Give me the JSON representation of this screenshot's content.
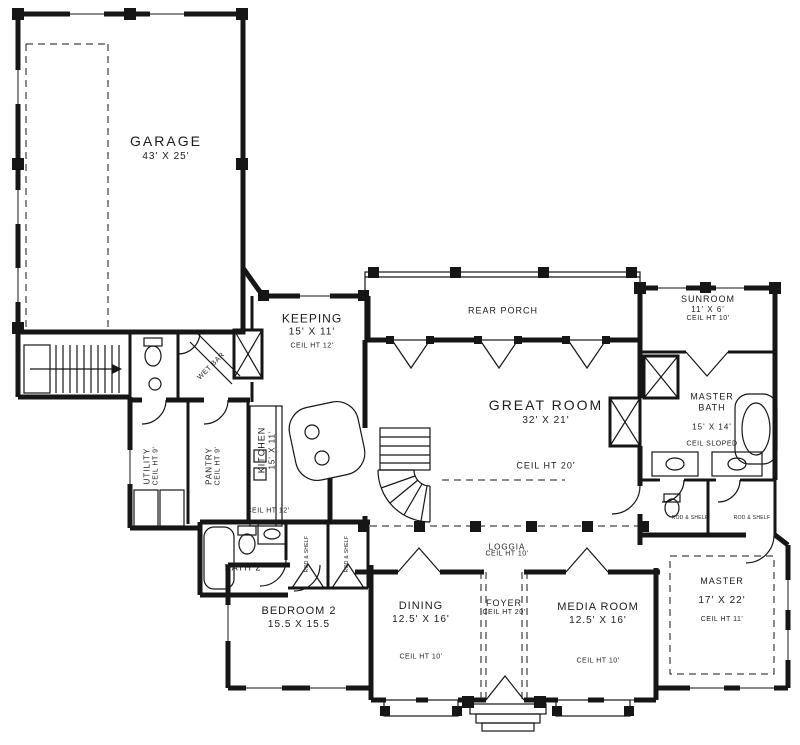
{
  "plan_title": "First floor plan",
  "colors": {
    "ink": "#161616",
    "paper": "#ffffff"
  },
  "rooms": {
    "garage": {
      "name": "GARAGE",
      "dims": "43' X 25'"
    },
    "keeping": {
      "name": "KEEPING",
      "dims": "15' X 11'",
      "ceil": "CEIL HT 12'"
    },
    "rear_porch": {
      "name": "REAR PORCH"
    },
    "sunroom": {
      "name": "SUNROOM",
      "dims": "11' X 6'",
      "ceil": "CEIL HT 10'"
    },
    "great_room": {
      "name": "GREAT ROOM",
      "dims": "32' X 21'",
      "ceil": "CEIL HT 20'"
    },
    "master_bath": {
      "name": "MASTER BATH",
      "dims": "15' X 14'",
      "ceil": "CEIL SLOPED"
    },
    "utility": {
      "name": "UTILITY",
      "ceil": "CEIL HT 9'"
    },
    "pantry": {
      "name": "PANTRY",
      "ceil": "CEIL HT 9'"
    },
    "kitchen": {
      "name": "KITCHEN",
      "dims": "15' X 11'",
      "ceil": "CEIL HT 12'"
    },
    "wet_bar": {
      "name": "WET BAR"
    },
    "bath2": {
      "name": "BATH 2"
    },
    "loggia": {
      "name": "LOGGIA",
      "ceil": "CEIL HT 10'"
    },
    "bedroom2": {
      "name": "BEDROOM 2",
      "dims": "15.5 X 15.5"
    },
    "dining": {
      "name": "DINING",
      "dims": "12.5' X 16'",
      "ceil": "CEIL HT 10'"
    },
    "foyer": {
      "name": "FOYER",
      "ceil": "CEIL HT 20'"
    },
    "media_room": {
      "name": "MEDIA ROOM",
      "dims": "12.5' X 16'",
      "ceil": "CEIL HT 10'"
    },
    "master": {
      "name": "MASTER",
      "dims": "17' X 22'",
      "ceil": "CEIL HT 11'"
    }
  },
  "labels": {
    "closet": "ROD & SHELF"
  }
}
